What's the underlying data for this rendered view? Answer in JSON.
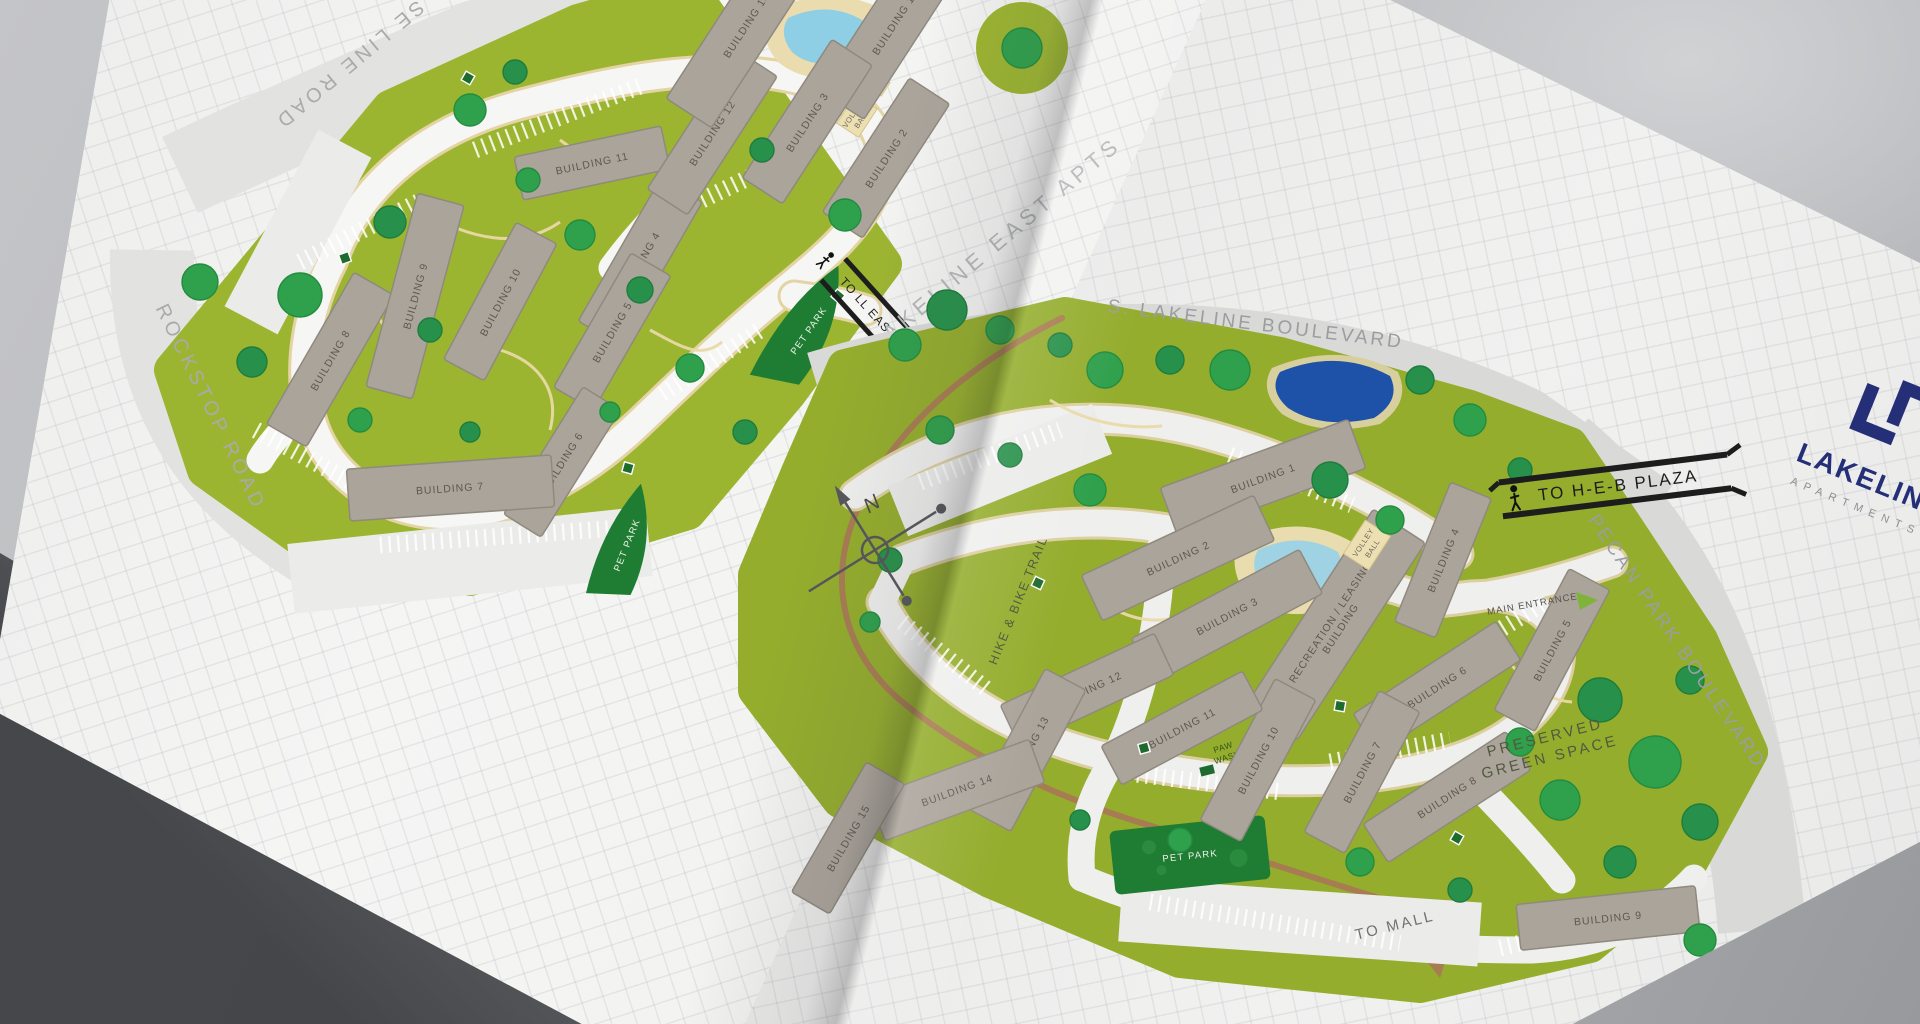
{
  "brochure": {
    "logo": {
      "brand": "LAKELINE",
      "tagline": "APARTMENTS"
    },
    "compass_north": "N"
  },
  "maps": {
    "left": {
      "roads": {
        "top_road": "SE LINE ROAD",
        "left_road": "ROCKSTOP ROAD",
        "right_label": "LAKELINE EAST APTS"
      },
      "buildings": [
        "BUILDING 1",
        "BUILDING 2",
        "BUILDING 3",
        "BUILDING 4",
        "BUILDING 5",
        "BUILDING 6",
        "BUILDING 7",
        "BUILDING 8",
        "BUILDING 9",
        "BUILDING 10",
        "BUILDING 11",
        "BUILDING 12",
        "BUILDING 13"
      ],
      "amenities": {
        "volleyball": [
          "VOLLEY",
          "BALL"
        ],
        "garage": "G",
        "pet_park_east": "PET PARK",
        "pet_park_south": "PET PARK"
      },
      "wayfinding": {
        "to_ll_east": "TO LL EAST"
      }
    },
    "right": {
      "roads": {
        "top_road": "S. LAKELINE BOULEVARD",
        "right_road": "PECAN PARK BOULEVARD"
      },
      "trail_label": "HIKE & BIKE TRAIL",
      "buildings": [
        "BUILDING 1",
        "BUILDING 2",
        "BUILDING 3",
        "BUILDING 4",
        "BUILDING 5",
        "BUILDING 6",
        "BUILDING 7",
        "BUILDING 8",
        "BUILDING 9",
        "BUILDING 10",
        "BUILDING 11",
        "BUILDING 12",
        "BUILDING 13",
        "BUILDING 14",
        "BUILDING 15"
      ],
      "recreation_building": [
        "RECREATION / LEASING",
        "BUILDING"
      ],
      "amenities": {
        "volleyball": [
          "VOLLEY",
          "BALL"
        ],
        "garage": "G",
        "pet_park": "PET PARK",
        "paw_wash": [
          "PAW",
          "WASH"
        ],
        "preserved": [
          "PRESERVED",
          "GREEN SPACE"
        ],
        "main_entrance": "MAIN ENTRANCE"
      },
      "wayfinding": {
        "to_heb_plaza": "TO H-E-B PLAZA",
        "to_mall": "TO MALL"
      }
    }
  },
  "colors": {
    "site_green": "#9cb531",
    "tree_green": "#2fa04c",
    "dark_green": "#1f7c33",
    "building_gray": "#aba49b",
    "pool_blue": "#8ecfe6",
    "pond_navy": "#1e52a8",
    "trail_brown": "#a87c52",
    "logo_navy": "#242f78",
    "paper": "#f2f2f1",
    "background": "#b7b8bb"
  }
}
